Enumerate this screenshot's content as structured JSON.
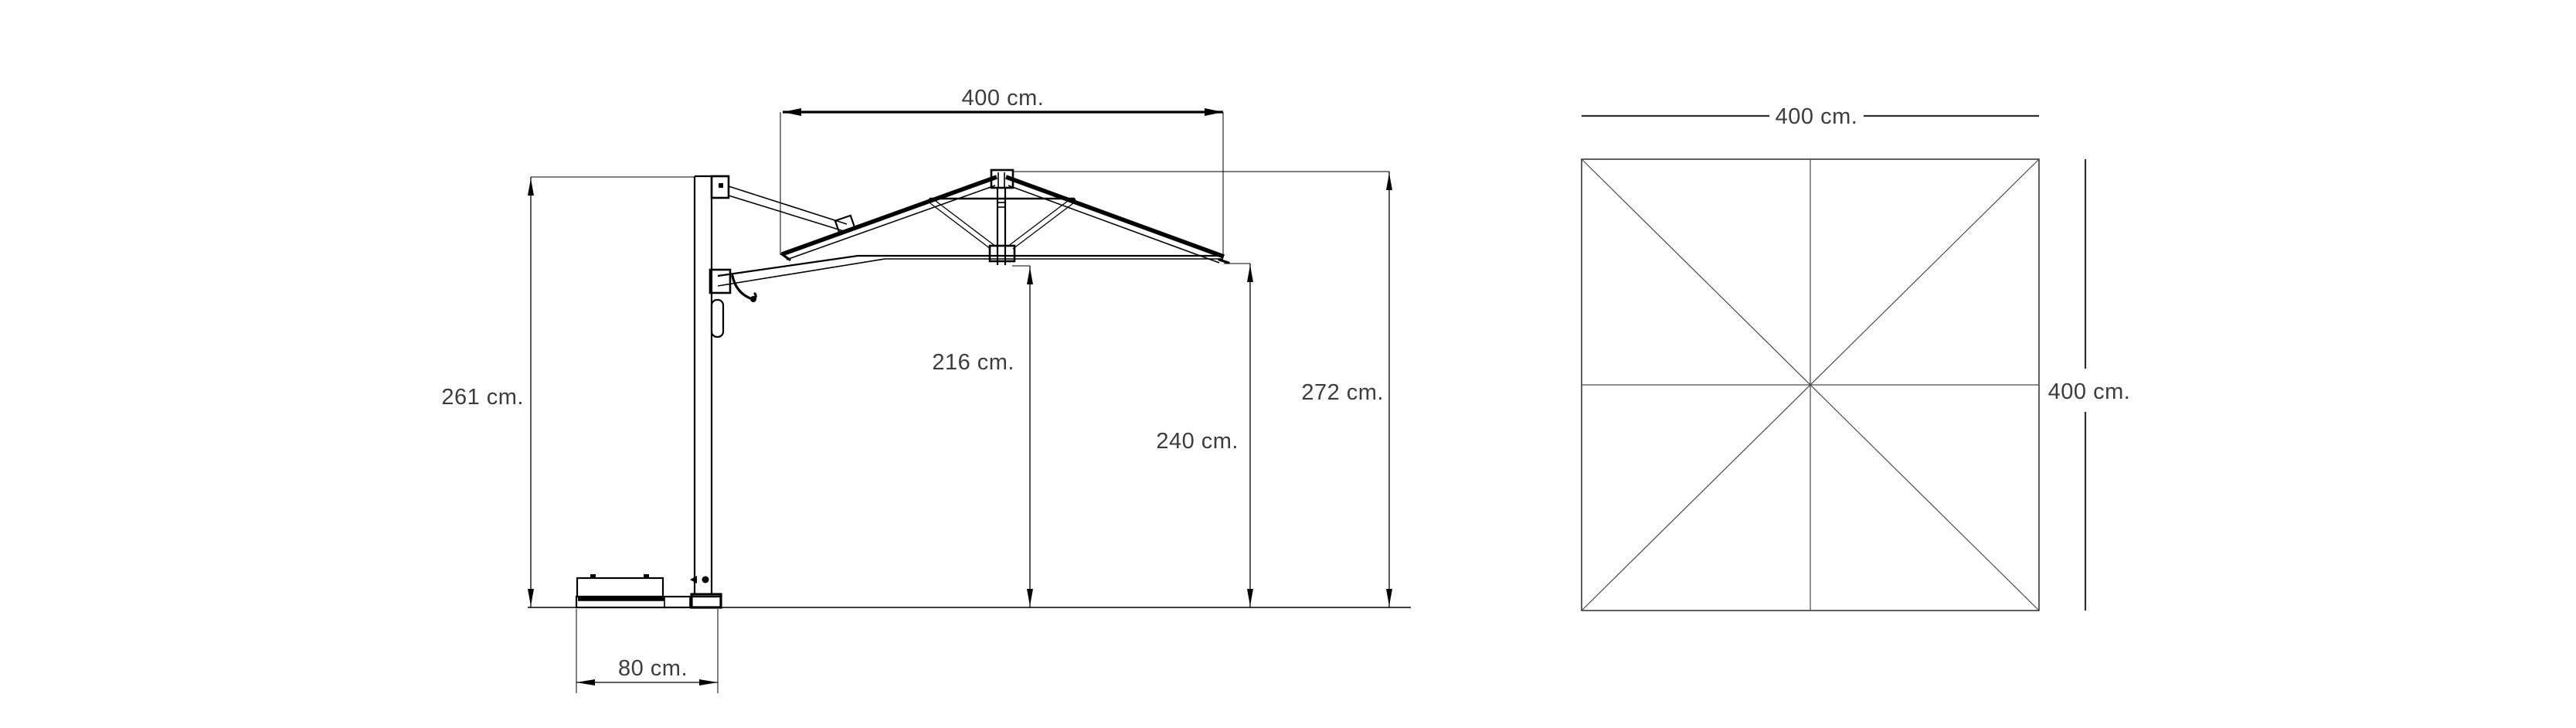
{
  "drawing": {
    "type": "technical-dimension-drawing",
    "subject": "cantilever-patio-umbrella",
    "background_color": "#ffffff",
    "line_color": "#000000",
    "label_color": "#3c3c3c"
  },
  "side_view": {
    "name": "umbrella-side-elevation",
    "dims": {
      "canopy_width": "400 cm.",
      "pole_height": "261 cm.",
      "clearance_height": "216 cm.",
      "edge_height": "240 cm.",
      "total_height": "272 cm.",
      "base_length": "80 cm."
    }
  },
  "top_view": {
    "name": "canopy-plan-view",
    "dims": {
      "width": "400 cm.",
      "depth": "400 cm."
    }
  }
}
